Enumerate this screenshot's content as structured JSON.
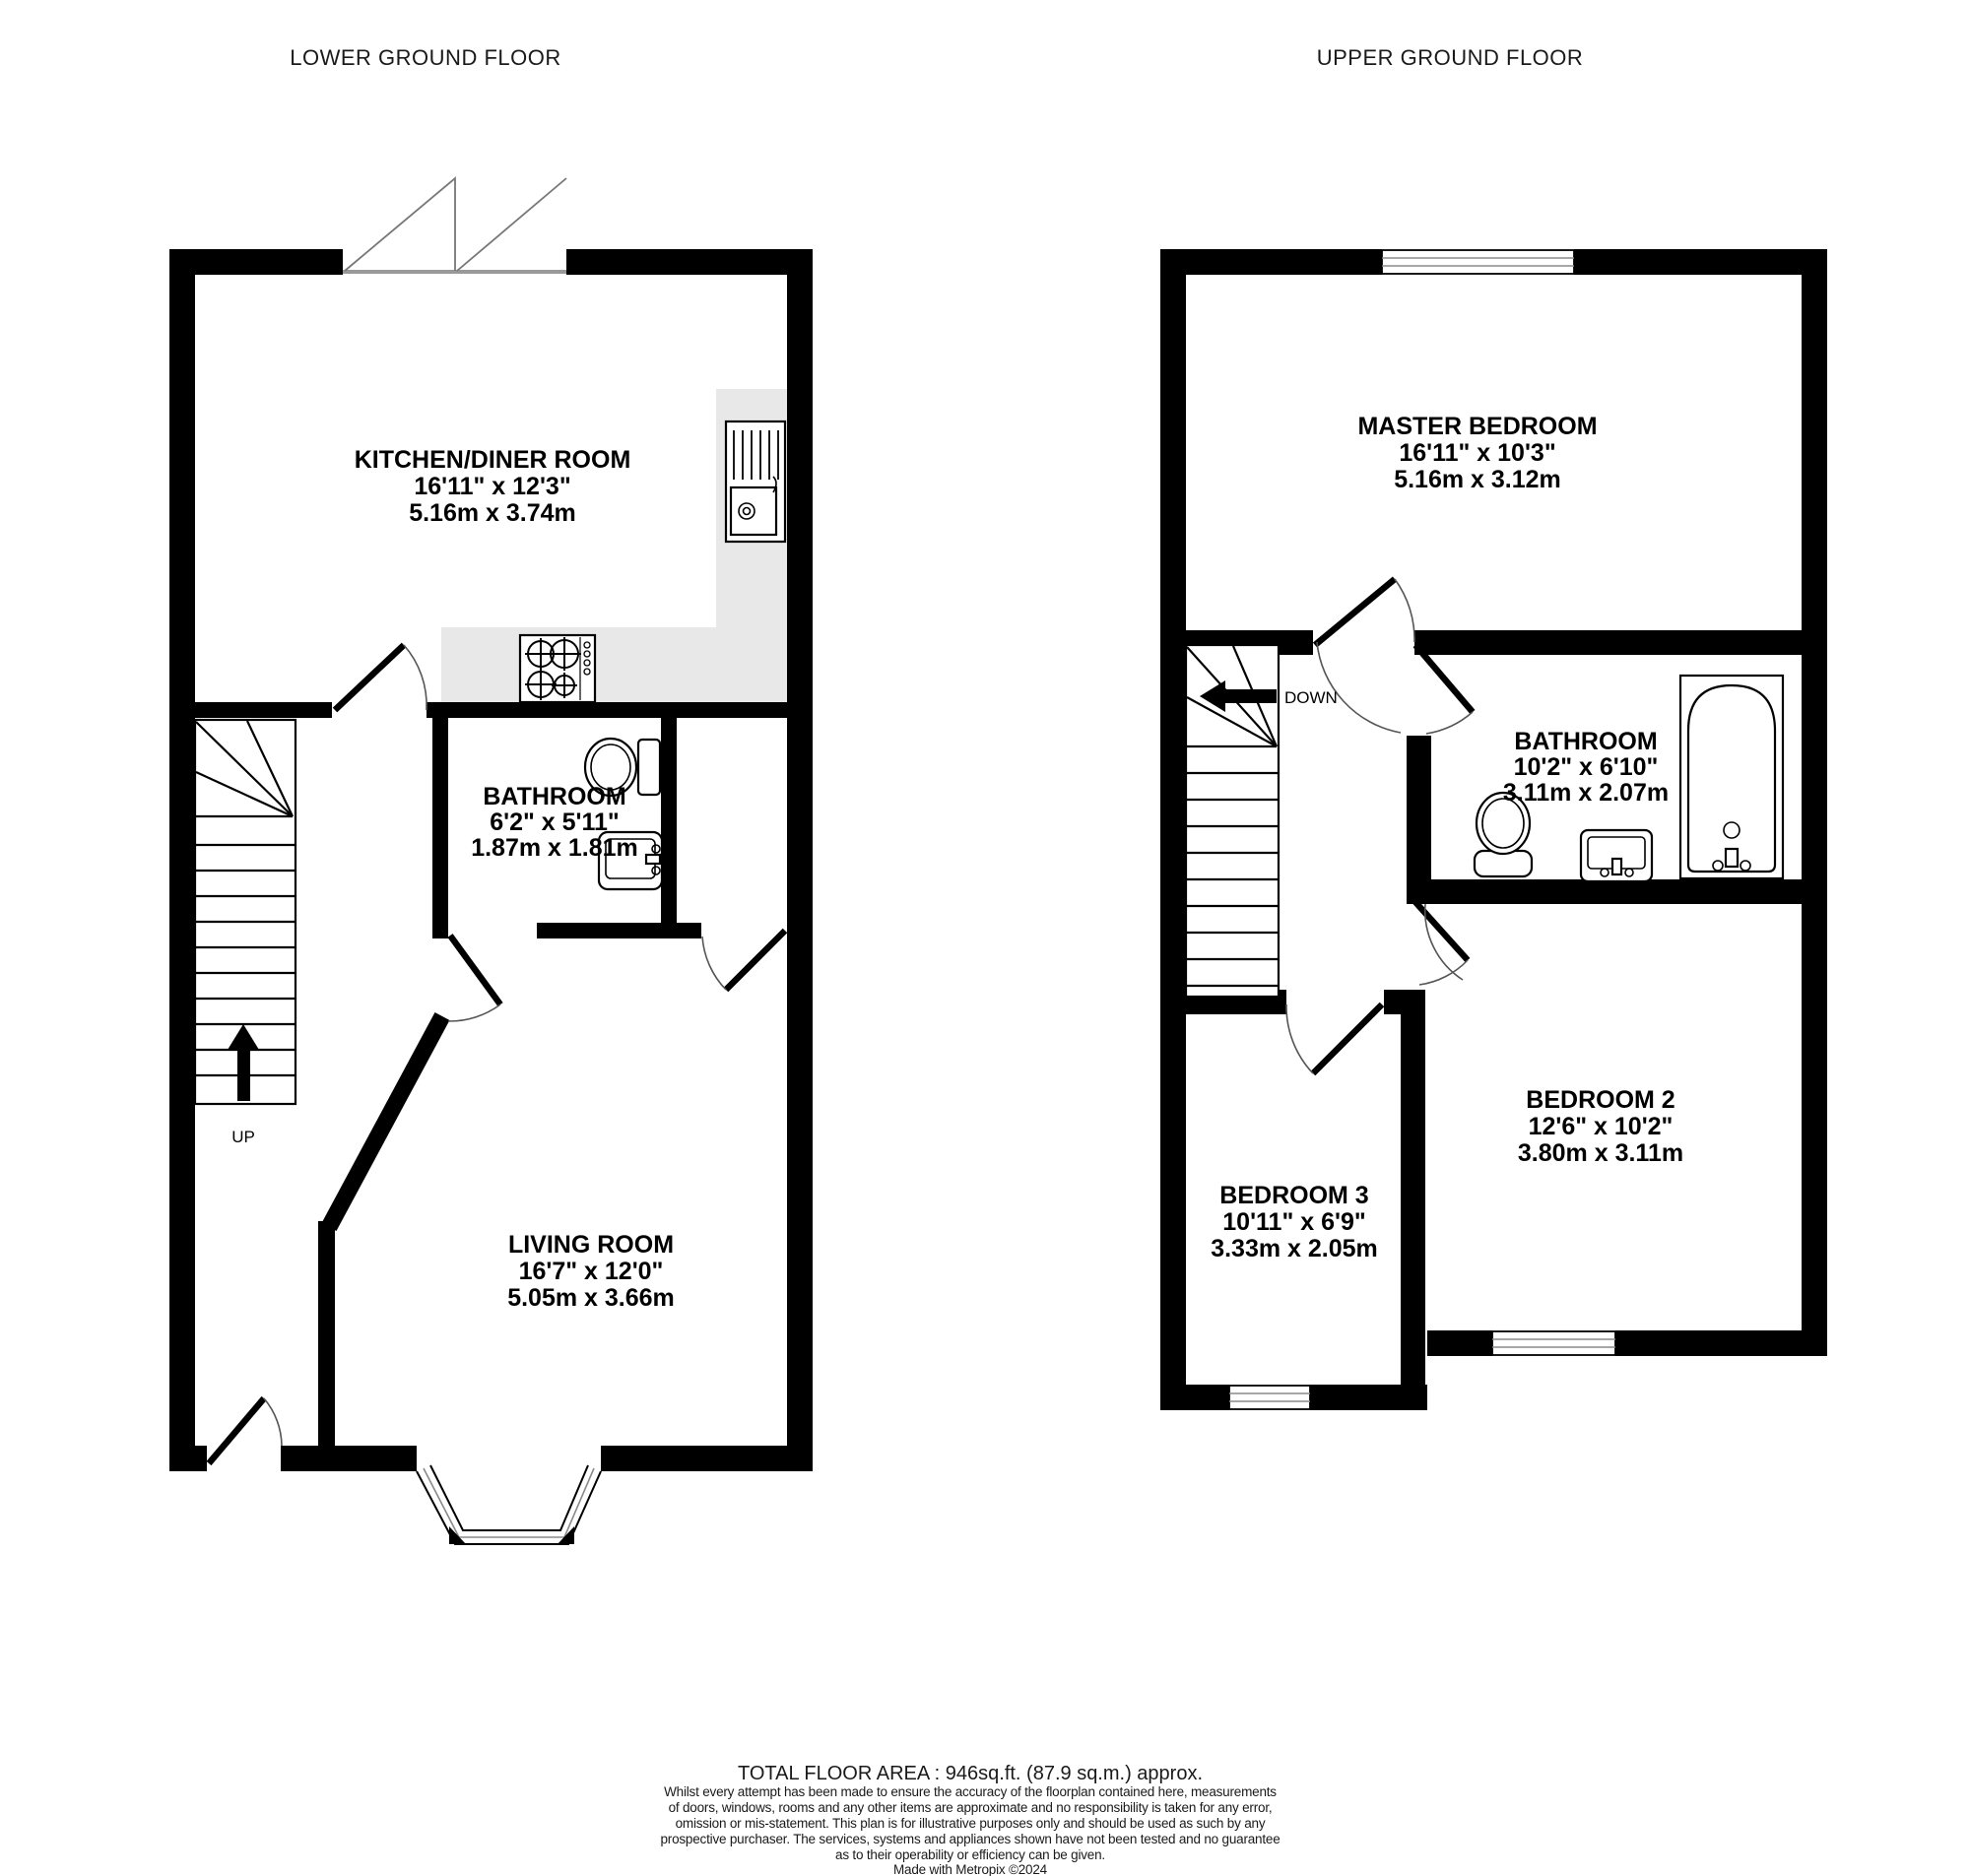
{
  "floors": [
    {
      "title": "LOWER GROUND FLOOR",
      "stair_label": "UP",
      "rooms": [
        {
          "name": "KITCHEN/DINER ROOM",
          "imperial": "16'11\"  x 12'3\"",
          "metric": "5.16m  x 3.74m"
        },
        {
          "name": "BATHROOM",
          "imperial": "6'2\"  x 5'11\"",
          "metric": "1.87m  x 1.81m"
        },
        {
          "name": "LIVING ROOM",
          "imperial": "16'7\"  x 12'0\"",
          "metric": "5.05m  x 3.66m"
        }
      ]
    },
    {
      "title": "UPPER GROUND FLOOR",
      "stair_label": "DOWN",
      "rooms": [
        {
          "name": "MASTER BEDROOM",
          "imperial": "16'11\"  x 10'3\"",
          "metric": "5.16m  x 3.12m"
        },
        {
          "name": "BATHROOM",
          "imperial": "10'2\"  x 6'10\"",
          "metric": "3.11m  x 2.07m"
        },
        {
          "name": "BEDROOM 2",
          "imperial": "12'6\"  x 10'2\"",
          "metric": "3.80m  x 3.11m"
        },
        {
          "name": "BEDROOM 3",
          "imperial": "10'11\"  x 6'9\"",
          "metric": "3.33m  x 2.05m"
        }
      ]
    }
  ],
  "footer": {
    "total_area": "TOTAL FLOOR AREA : 946sq.ft. (87.9 sq.m.) approx.",
    "disclaimer_lines": [
      "Whilst every attempt has been made to ensure the accuracy of the floorplan contained here, measurements",
      "of doors, windows, rooms and any other items are approximate and no responsibility is taken for any error,",
      "omission or mis-statement. This plan is for illustrative purposes only and should be used as such by any",
      "prospective purchaser. The services, systems and appliances shown have not been tested and no guarantee",
      "as to their operability or efficiency can be given."
    ],
    "credit": "Made with Metropix ©2024"
  },
  "colors": {
    "wall": "#000000",
    "counter": "#e8e8e8",
    "window_line": "#8a8a8a"
  }
}
